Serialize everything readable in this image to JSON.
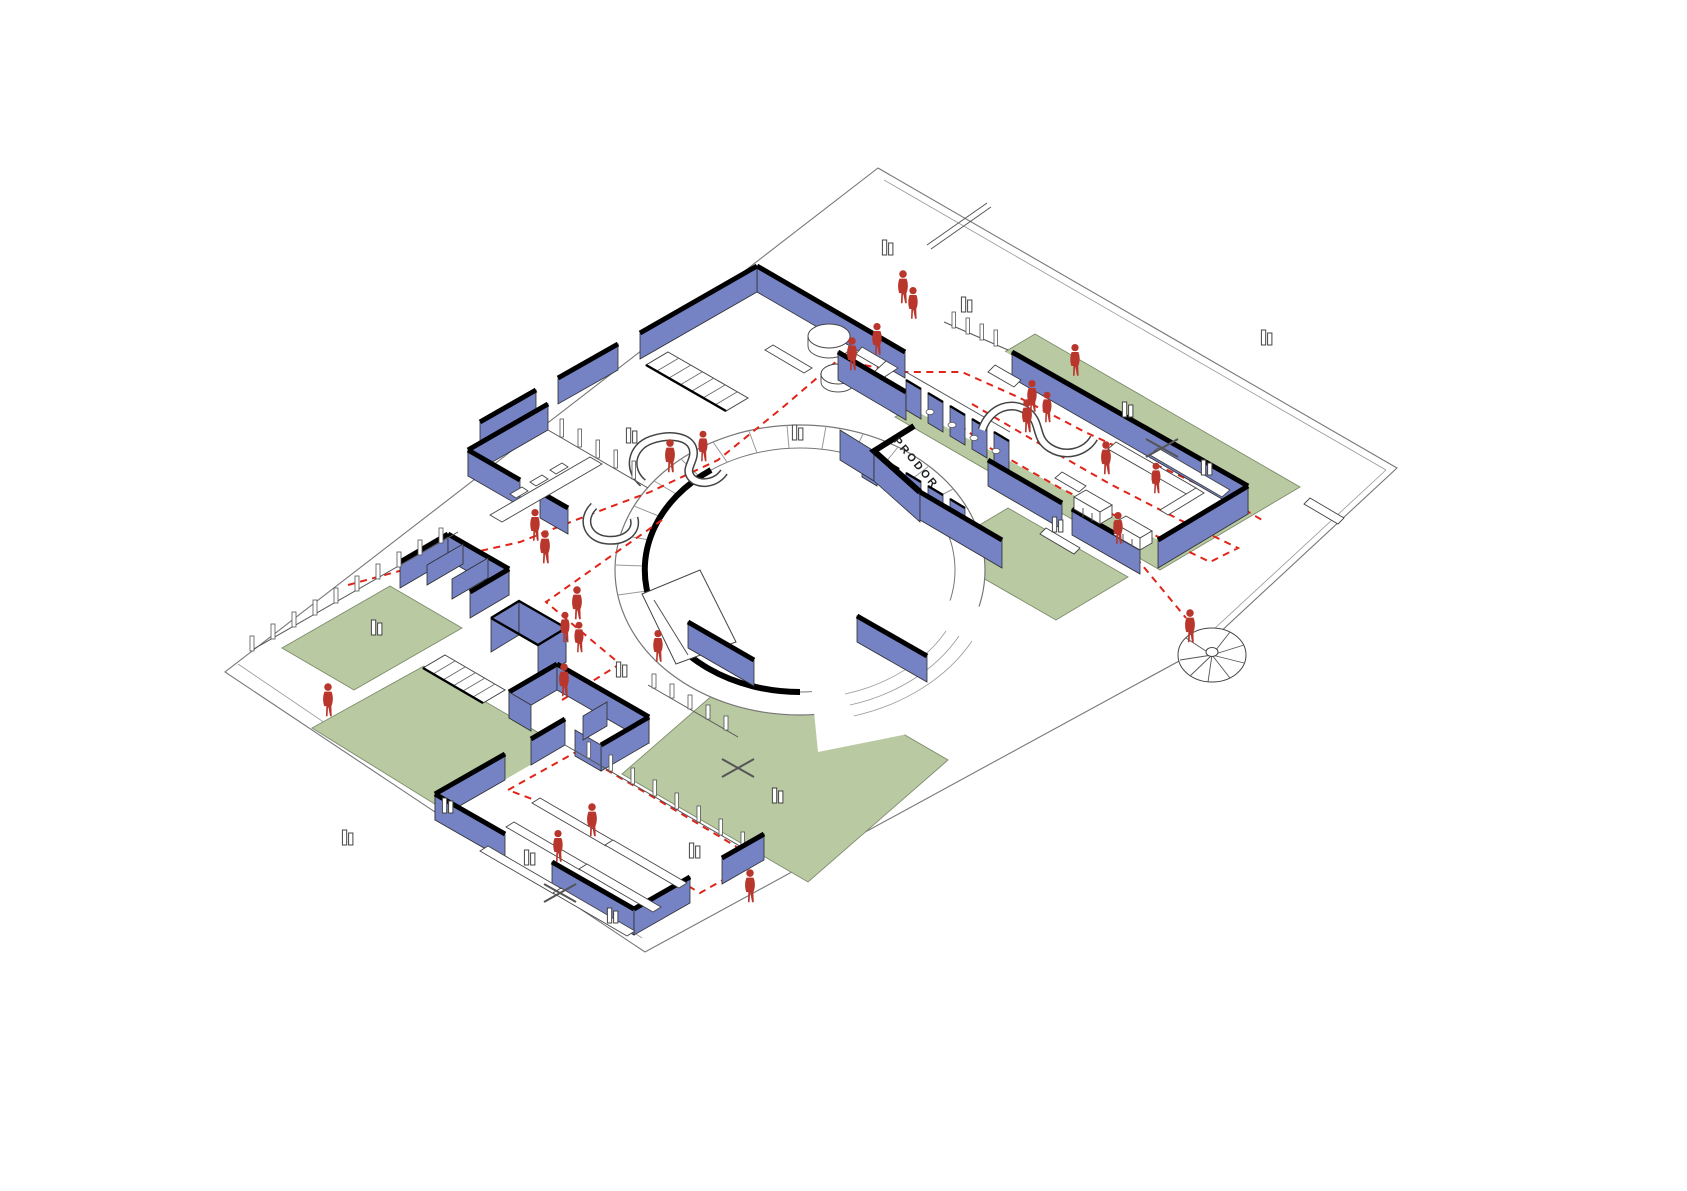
{
  "meta": {
    "type": "axonometric floor plan diagram",
    "projection": "isometric",
    "background": "white"
  },
  "colors": {
    "paper": "#ffffff",
    "plate": "#ffffff",
    "wall": "#7583c5",
    "wall-cap": "#000000",
    "lawn": "#b9c9a2",
    "lawn-edge": "#7d8c6b",
    "figure": "#b8362c",
    "dash": "#e02418"
  },
  "labels": {
    "wall_text": "PRODOR"
  },
  "legend": {
    "blue": "walls",
    "green": "lawn / play areas",
    "red_dashed": "circulation route",
    "red_silhouettes": "people"
  },
  "inventory": {
    "people_count": 25,
    "lawn_count": 5,
    "door_or_tree_markers": 16,
    "play_cross_marks": 3,
    "staircases": [
      "entrance-stair",
      "garden-stair",
      "spiral-stair"
    ],
    "spaces": [
      "entrance-hall",
      "lounge",
      "kitchen-servery",
      "office-rooms",
      "dining-room",
      "sanitary-block",
      "classroom-wing",
      "circular-courtyard",
      "playground-lawns"
    ]
  }
}
